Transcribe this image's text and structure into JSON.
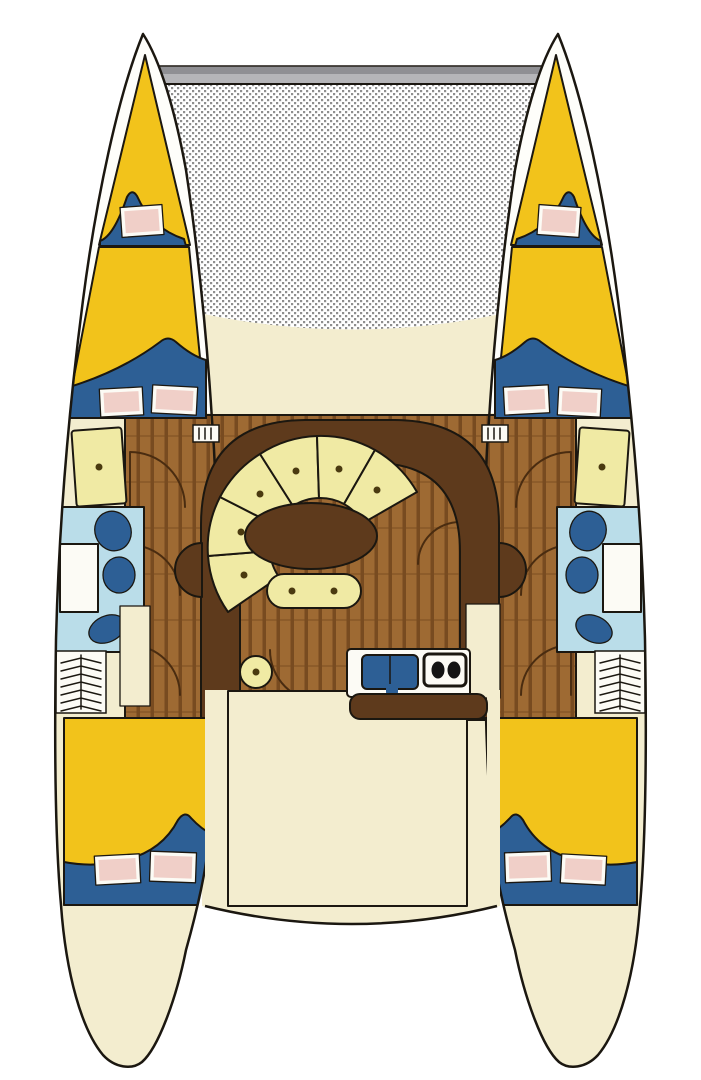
{
  "diagram": {
    "alt_text": "Top-down interior layout plan of a sailing catamaran: trampoline net and crossbeam at the bow, two hulls each with a forepeak V-berth, a fore double cabin, a bathroom with shower and fixtures, companionway steps and an aft double cabin; central bridge-deck salon with a curved settee of six pale cushions around an oval table, a small bench, a stool, a galley with double sink and two-burner stove, and an aft cockpit.",
    "inventory": {
      "hulls": 2,
      "forepeak_berths": 2,
      "fore_double_cabins": 2,
      "aft_double_cabins": 2,
      "bathrooms": 2,
      "shower_pans": 2,
      "bathroom_fixtures": 6,
      "pillows": 10,
      "settee_cushions": 6,
      "settee_cushion_buttons": 6,
      "bench_seats": 1,
      "bench_buttons": 2,
      "stools": 1,
      "side_seats": 2,
      "galley_sinks": 1,
      "stove_burners": 2,
      "companionway_steps": 2,
      "deck_hatches": 2,
      "door_swings": 8,
      "trampoline_nets": 1,
      "bow_crossbeams": 1
    }
  },
  "colors": {
    "page_white": "#FFFFFF",
    "hull_white": "#FEFEFA",
    "deck_cream": "#F3EDCF",
    "bed_yellow": "#F2C31B",
    "blanket_navy": "#2D5F95",
    "pillow_pink": "#F0CFC8",
    "fixture_white": "#FCFBF5",
    "bath_blue": "#BADDE9",
    "wood_light": "#9E6A33",
    "wood_dark": "#784B20",
    "salon_brown": "#5E3A1C",
    "cushion_pale": "#F0EAA4",
    "dot_brown": "#4A3A10",
    "net_white": "#FFFFFF",
    "net_gray": "#8E8E8E",
    "beam_gray": "#B5B5B8",
    "beam_gray_dark": "#8F8F93",
    "line": "#1B1710",
    "door_brown": "#4A2C10",
    "burner_black": "#141414"
  }
}
